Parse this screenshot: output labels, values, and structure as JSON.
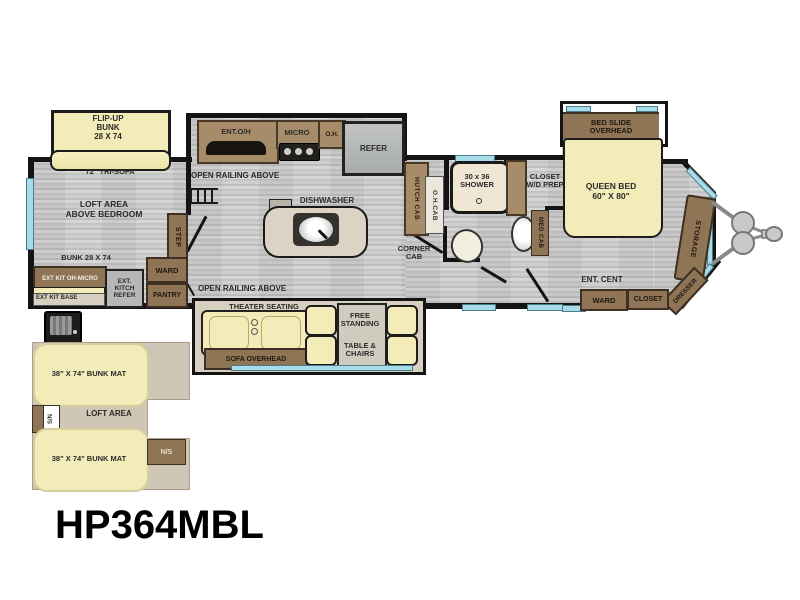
{
  "model": "HP364MBL",
  "colors": {
    "floor_gray": "#c9c9c9",
    "cushion_cream": "#f3ecb9",
    "cabinet_brown": "#8f7456",
    "counter_tan": "#cfc6b5",
    "appliance_gray": "#b6b8b8",
    "window_blue": "#a9dce9",
    "wall_black": "#141414"
  },
  "front": {
    "flip_up_bunk": "FLIP-UP\nBUNK\n28 X 74",
    "tri_sofa": "72\" TRI-SOFA",
    "loft_area": "LOFT AREA\nABOVE BEDROOM",
    "bunk": "BUNK 28 X 74",
    "step": "STEP",
    "ward": "WARD",
    "pantry": "PANTRY",
    "ext_kit_oh_micro": "EXT KIT OH-MICRO",
    "ext_kit_base": "EXT KIT BASE",
    "ext_kitch_refer": "EXT.\nKITCH\nREFER",
    "open_railing_top": "OPEN RAILING ABOVE",
    "open_railing_bottom": "OPEN RAILING ABOVE"
  },
  "kitchen": {
    "ent_oh": "ENT.O/H",
    "micro": "MICRO",
    "oh": "O.H.",
    "refer": "REFER",
    "dishwasher": "DISHWASHER",
    "hutch_cab": "HUTCH CAB",
    "oh_cab": "O.H.CAB",
    "corner_cab": "CORNER\nCAB"
  },
  "bath": {
    "shower": "30 x 36\nSHOWER",
    "closet_wd_prep": "CLOSET\nW/D PREP",
    "med_cab": "MED CAB"
  },
  "bedroom": {
    "bed_slide_overhead": "BED SLIDE\nOVERHEAD",
    "queen_bed": "QUEEN BED\n60\" X 80\"",
    "storage": "STORAGE",
    "dresser": "DRESSER",
    "ent_cent": "ENT. CENT",
    "ward": "WARD",
    "closet": "CLOSET"
  },
  "living": {
    "theater_seating": "THEATER SEATING",
    "sofa_overhead": "SOFA OVERHEAD",
    "free_standing": "FREE\nSTANDING",
    "table_chairs": "TABLE &\nCHAIRS"
  },
  "rear_loft": {
    "bunk_mat_top": "38\" X 74\" BUNK MAT",
    "loft_area": "LOFT AREA",
    "bunk_mat_bottom": "38\" X 74\" BUNK MAT",
    "sn": "S/N",
    "ns": "N/S"
  }
}
